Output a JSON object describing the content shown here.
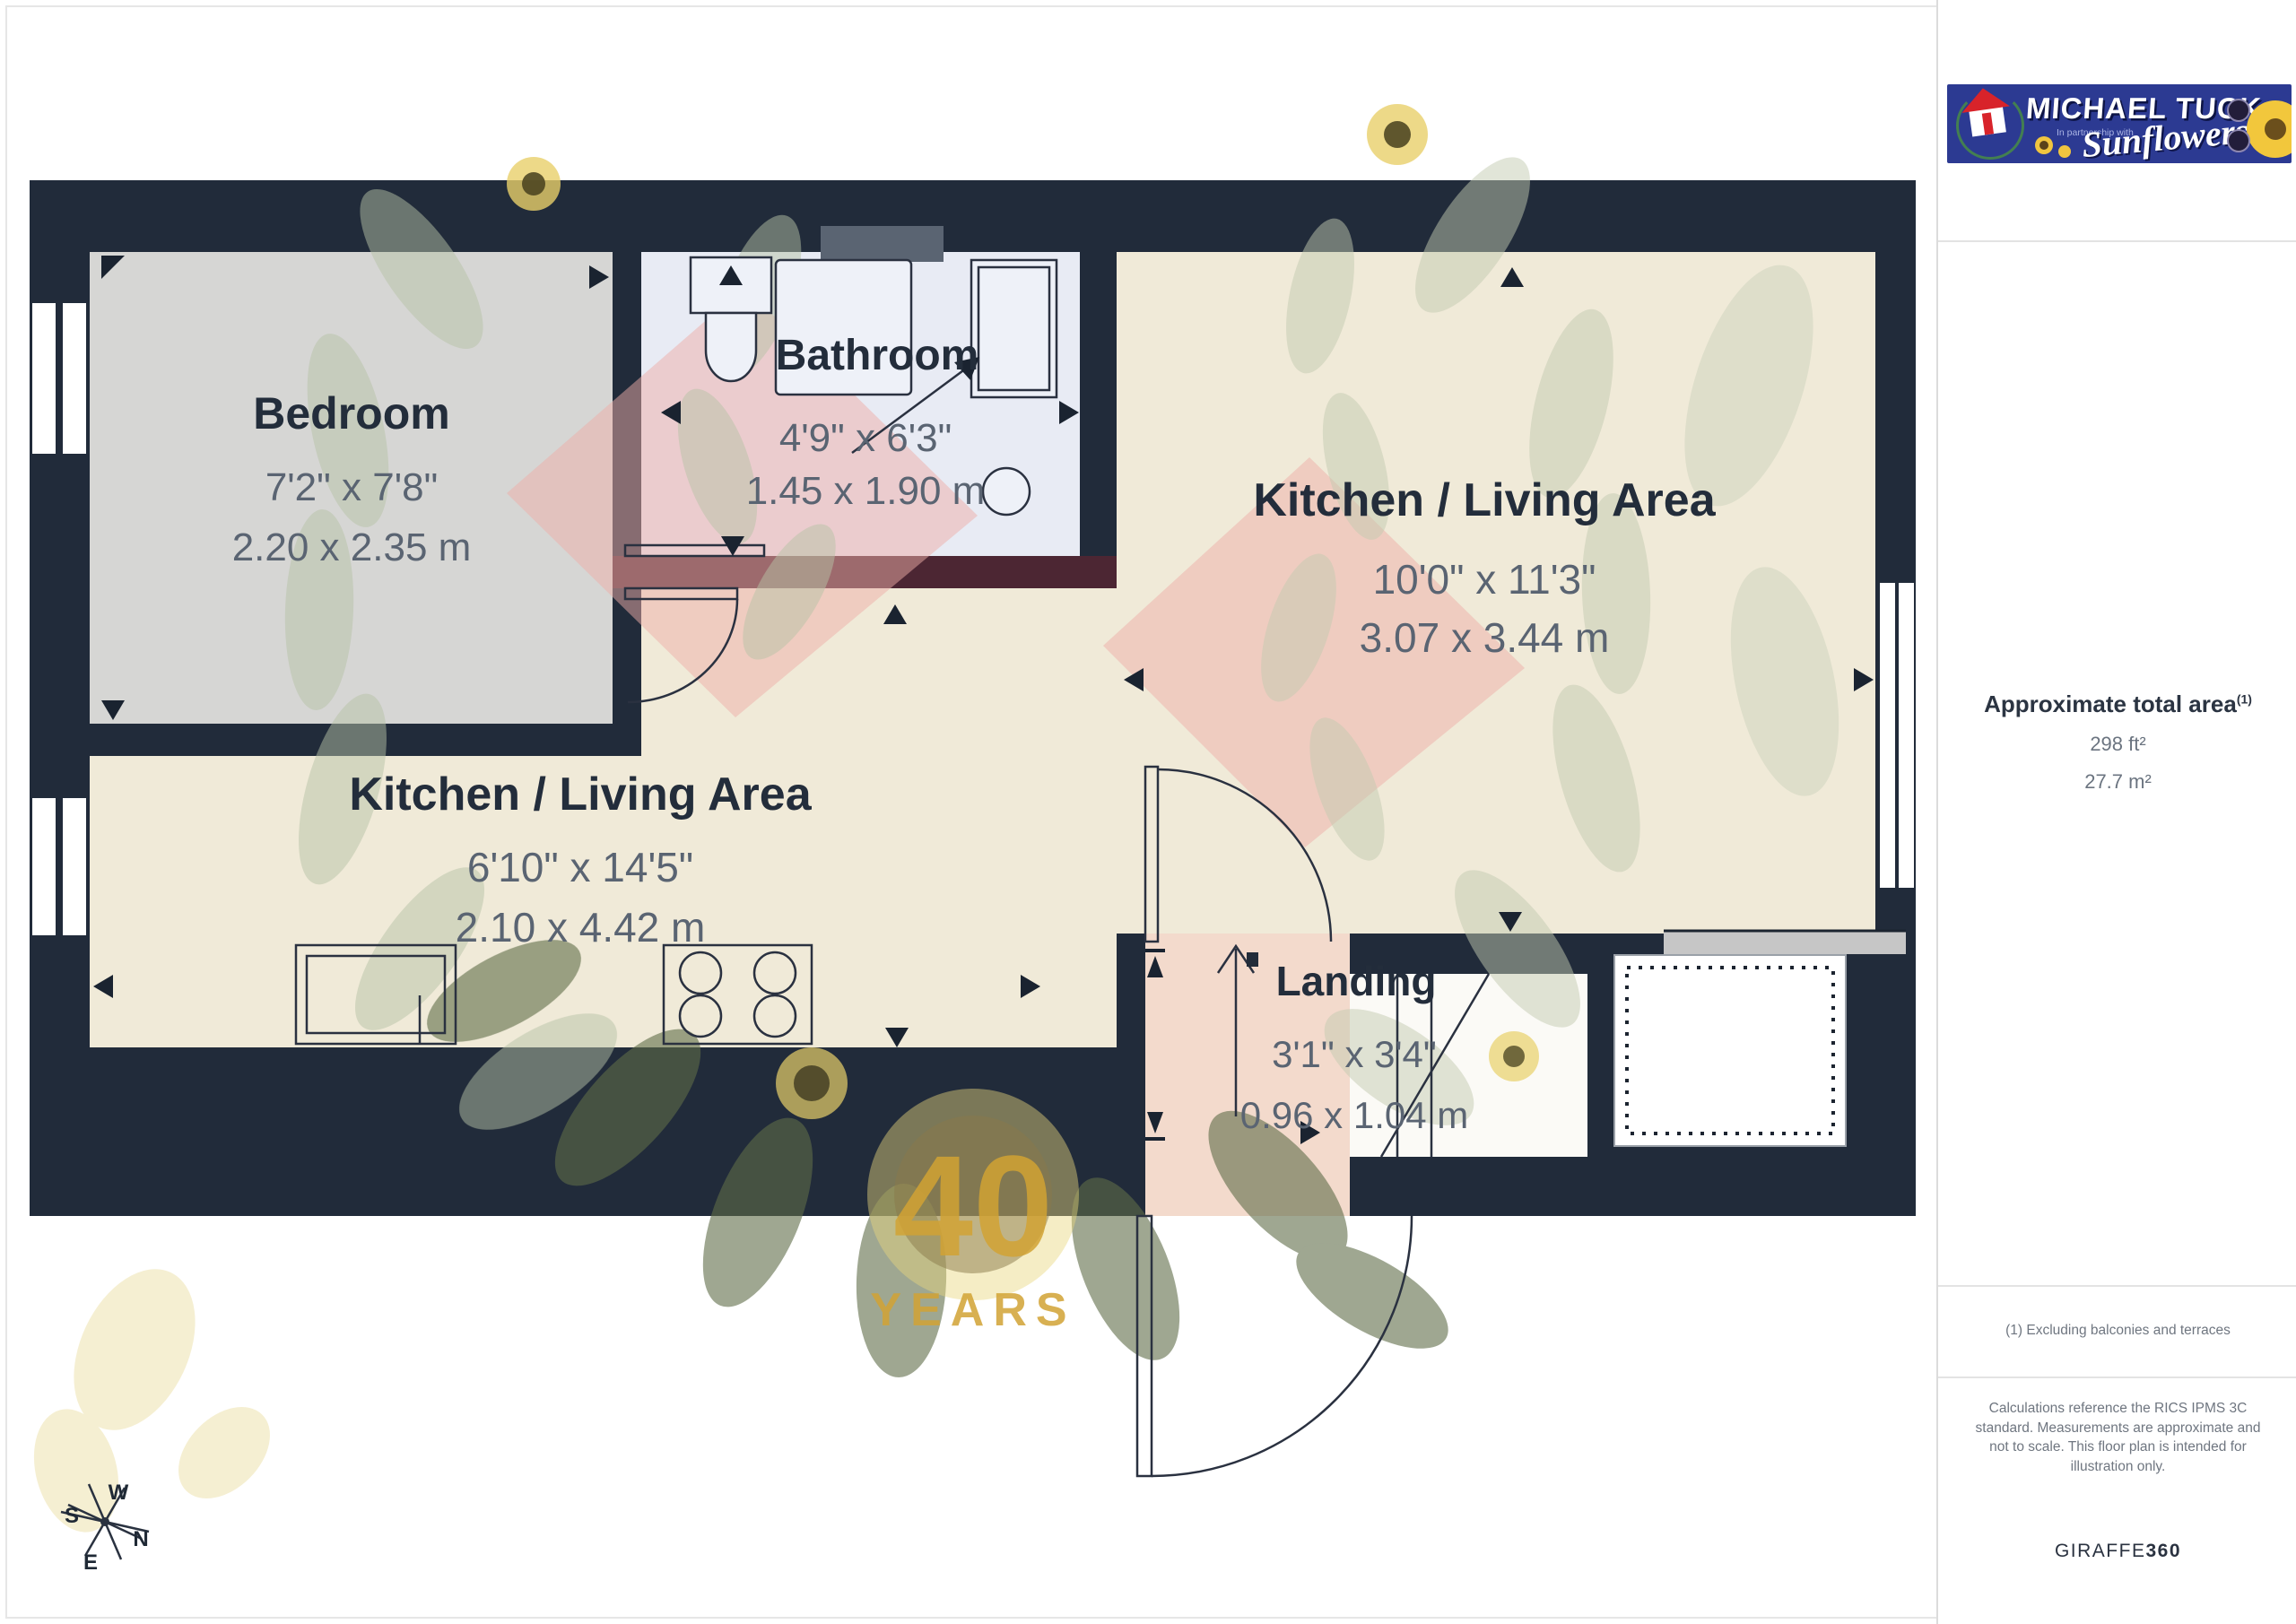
{
  "plan": {
    "rooms": {
      "bedroom": {
        "name": "Bedroom",
        "imperial": "7'2\" x 7'8\"",
        "metric": "2.20 x 2.35 m"
      },
      "bathroom": {
        "name": "Bathroom",
        "imperial": "4'9\" x 6'3\"",
        "metric": "1.45 x 1.90 m"
      },
      "kitchen_living_main": {
        "name": "Kitchen / Living Area",
        "imperial": "10'0\" x 11'3\"",
        "metric": "3.07 x 3.44 m"
      },
      "kitchen_living_strip": {
        "name": "Kitchen / Living Area",
        "imperial": "6'10\" x 14'5\"",
        "metric": "2.10 x 4.42 m"
      },
      "landing": {
        "name": "Landing",
        "imperial": "3'1\" x 3'4\"",
        "metric": "0.96 x 1.04 m"
      }
    },
    "compass": {
      "n": "N",
      "s": "S",
      "e": "E",
      "w": "W"
    },
    "watermark": {
      "number": "40",
      "years": "YEARS"
    }
  },
  "sidebar": {
    "logo": {
      "brand": "MICHAEL TUCK",
      "partnership": "In partnership with",
      "script": "Sunflowers"
    },
    "area": {
      "title": "Approximate total area",
      "sup": "(1)",
      "imperial": "298 ft²",
      "metric": "27.7 m²"
    },
    "note": "(1) Excluding balconies and terraces",
    "disclaimer": "Calculations reference the RICS IPMS 3C standard. Measurements are approximate and not to scale. This floor plan is intended for illustration only.",
    "credit": {
      "brand": "GIRAFFE",
      "suffix": "360"
    }
  },
  "colors": {
    "wall": "#212b3a",
    "bedroom_floor": "#d6d6d4",
    "bathroom_floor": "#e8ebf4",
    "living_floor": "#f0ead8",
    "landing_floor": "#f3dacc",
    "accent_maroon": "#4c2633",
    "watermark_salmon": "#eeada8",
    "watermark_gold": "#d2a334",
    "logo_navy": "#2c3a92"
  }
}
